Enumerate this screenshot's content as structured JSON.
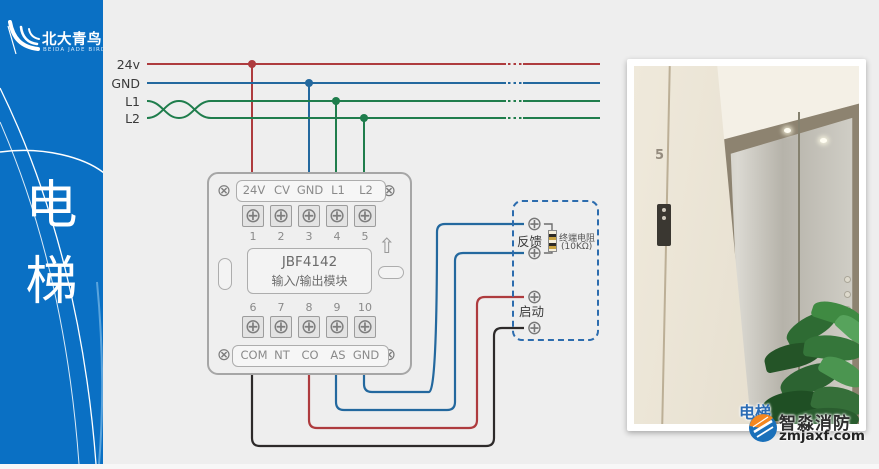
{
  "sidebar": {
    "brand_cn": "北大青鸟",
    "brand_en": "BEIDA JADE BIRD",
    "vertical_title_line1": "电",
    "vertical_title_line2": "梯"
  },
  "bus": {
    "labels": [
      "24v",
      "GND",
      "L1",
      "L2"
    ]
  },
  "module": {
    "model": "JBF4142",
    "name": "输入/输出模块",
    "top_terminals": [
      "24V",
      "CV",
      "GND",
      "L1",
      "L2"
    ],
    "top_numbers": [
      "1",
      "2",
      "3",
      "4",
      "5"
    ],
    "bottom_numbers": [
      "6",
      "7",
      "8",
      "9",
      "10"
    ],
    "bottom_terminals": [
      "COM",
      "NT",
      "CO",
      "AS",
      "GND"
    ],
    "mount_screw_glyph": "⊗",
    "terminal_screw_glyph": "⊕",
    "up_arrow_glyph": "⇧"
  },
  "device": {
    "feedback_label": "反馈",
    "start_label": "启动",
    "resistor_name": "终端电阻",
    "resistor_value": "(10KΩ)",
    "terminal_glyph": "⊕"
  },
  "photo": {
    "floor_sign": "5"
  },
  "watermark": {
    "elevator": "电梯",
    "brand": "智淼消防",
    "site": "zmjaxf.com"
  },
  "colors": {
    "sidebar_blue": "#0a70c4",
    "wire_24v_red": "#ae3b3e",
    "wire_gnd_blue": "#23689e",
    "wire_signal_green": "#1f7d4c",
    "wire_start_black": "#2d2a2a",
    "device_box_dashed_blue": "#2c6cae",
    "watermark_blue": "#2b6cb5",
    "logo_orange": "#f5871f"
  }
}
